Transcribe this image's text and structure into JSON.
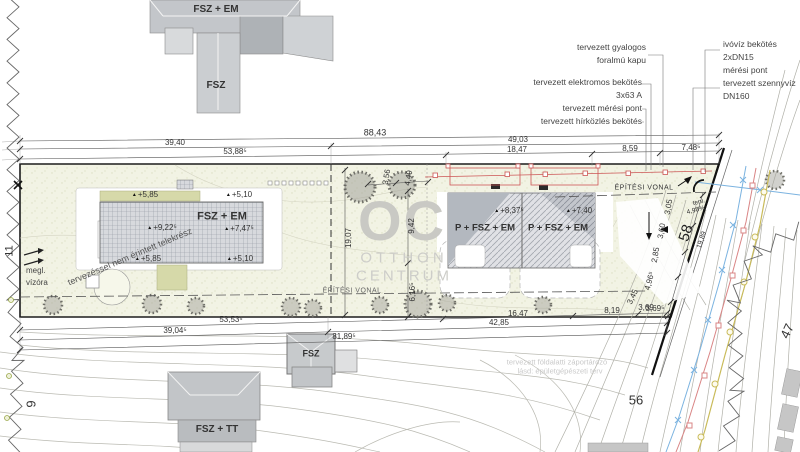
{
  "watermark": {
    "logo": "OC",
    "name1": "OTTHON",
    "name2": "CENTRUM"
  },
  "buildings": {
    "top_main": "FSZ + EM",
    "top_wing": "FSZ",
    "left_main": "FSZ + EM",
    "right_a": "P + FSZ + EM",
    "right_b": "P + FSZ + EM",
    "south_small": "FSZ",
    "south_large": "FSZ + TT"
  },
  "elevations": {
    "left": [
      "+5,85",
      "+5,10",
      "+9,22⁵",
      "+7,47⁵",
      "+5,85",
      "+5,10"
    ],
    "right": [
      "+8,37⁵",
      "+7,40"
    ]
  },
  "callouts": {
    "left": [
      "tervezett gyalogos",
      "foralmú kapu",
      "tervezett elektromos bekötés",
      "3x63 A",
      "tervezett mérési pont",
      "tervezett hírközlés bekötés"
    ],
    "right": [
      "ivóvíz bekötés",
      "2xDN15",
      "mérési pont",
      "tervezett szennyvíz",
      "DN160"
    ]
  },
  "dims": {
    "top": [
      "88,43",
      "39,40",
      "49,03",
      "53,88⁵",
      "18,47",
      "8,59",
      "7,48⁵"
    ],
    "bottom": [
      "53,53⁵",
      "16,47",
      "8,19",
      "3,69⁵",
      "39,04⁵",
      "42,85",
      "81,89⁵"
    ],
    "vertical": [
      "19,07",
      "9,42",
      "3,56",
      "4,49",
      "6,16⁵"
    ],
    "right": [
      "3,05",
      "3,60",
      "2,85",
      "4,96⁵",
      "3,69",
      "3,45",
      "19,89"
    ]
  },
  "numbers": {
    "n58": "58",
    "n56": "56",
    "n47": "47",
    "n9": "9",
    "n11": "11"
  },
  "notes": {
    "not_affected": "tervezéssel nem érintett telekrész",
    "building_line": "ÉPÍTÉSI VONAL",
    "water_meter": [
      "megl.",
      "vízóra"
    ],
    "slope": [
      "terv.",
      "4,98%"
    ],
    "storm": [
      "tervezett földalatti záportározó",
      "lásd: épületgépészeti terv"
    ]
  },
  "icons": {
    "level_marker": "▲"
  },
  "colors": {
    "red_utility": "#cc5555",
    "blue_utility": "#7bb3e0",
    "yellow_utility": "#c9bb5a",
    "parcel_fill": "#f2f3e4",
    "accent_green": "#d6d9a9"
  }
}
